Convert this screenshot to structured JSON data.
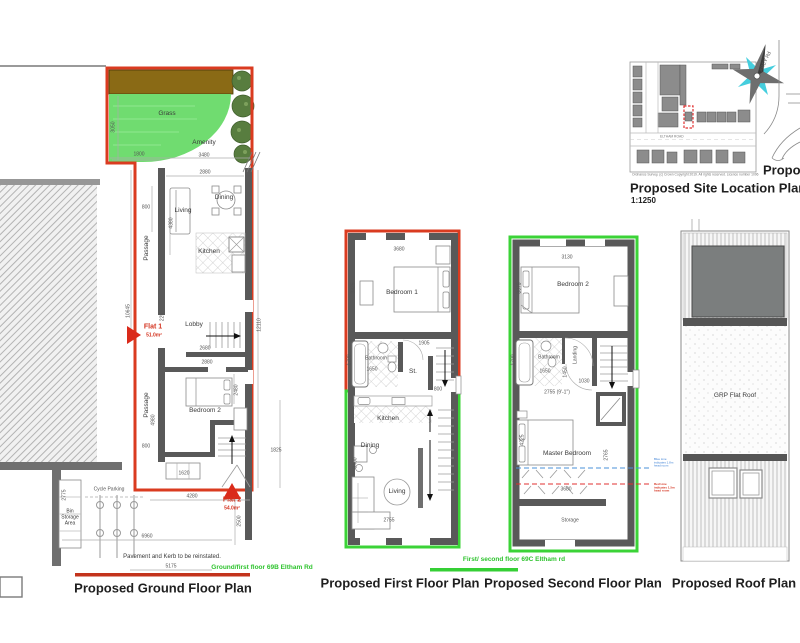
{
  "ground": {
    "title": "Proposed Ground Floor Plan",
    "address": "Ground/first floor 69B Eltham Rd",
    "flat1": {
      "name": "Flat 1",
      "area": "51.0m²"
    },
    "flat2": {
      "name": "Flat 2",
      "area": "54.0m²"
    },
    "rooms": {
      "grass": "Grass",
      "amenity": "Amenity",
      "living": "Living",
      "dining": "Dining",
      "kitchen": "Kitchen",
      "lobby": "Lobby",
      "bedroom2": "Bedroom 2",
      "passage": "Passage",
      "cycle_parking": "Cycle Parking",
      "bin_storage": "Bin Storage Area"
    },
    "note": "Pavement and Kerb to be reinstated.",
    "dims": {
      "d3050": "3050",
      "d1800": "1800",
      "d3480": "3480",
      "d2880a": "2880",
      "d800a": "800",
      "d4380": "4380",
      "d225": "225",
      "d10645": "10645",
      "d2680": "2680",
      "d12110": "12110",
      "d2880b": "2880",
      "d2480": "2480",
      "d4980": "4980",
      "d800b": "800",
      "d1620": "1620",
      "d1825": "1825",
      "d4280": "4280",
      "d2500": "2500",
      "d2775": "2775",
      "d6960": "6960",
      "d5175": "5175"
    }
  },
  "first": {
    "title": "Proposed First Floor Plan",
    "rooms": {
      "bedroom1": "Bedroom 1",
      "bathroom": "Bathroom",
      "st": "St.",
      "kitchen": "Kitchen",
      "dining": "Dining",
      "living": "Living"
    },
    "dims": {
      "d3680": "3680",
      "d3325": "3325",
      "d1700": "1700",
      "d1650": "1650",
      "d1905": "1905",
      "d800": "800",
      "d3400": "3400",
      "d2755": "2755"
    }
  },
  "second": {
    "title": "Proposed Second Floor Plan",
    "address": "First/ second floor 69C Eltham rd",
    "rooms": {
      "bedroom2": "Bedroom 2",
      "bathroom": "Bathroom",
      "landing": "Landing",
      "master": "Master Bedroom",
      "storage": "Storage"
    },
    "dims": {
      "d3130": "3130",
      "d3075": "3075",
      "d1700": "1700",
      "d1650": "1650",
      "d1450": "1450",
      "d1030": "1030",
      "d2755ft": "2755 (9'-1\")",
      "d4225": "4225",
      "d2765": "2765",
      "d3680": "3680"
    },
    "notes": {
      "blue": "Blue Line indicates 1.8m head room",
      "red": "Red Line indicates 1.5m head room"
    }
  },
  "roof": {
    "title": "Proposed Roof Plan",
    "label": "GRP Flat Roof"
  },
  "site": {
    "title": "Proposed Site Location Plan",
    "scale": "1:1250",
    "road": "AREY Rd",
    "map_road": "ELTHAM ROAD",
    "copyright": "Ordnance Survey, (c) Crown Copyright 2019. All rights reserved. Licence number 1096",
    "partial": "Propose"
  }
}
